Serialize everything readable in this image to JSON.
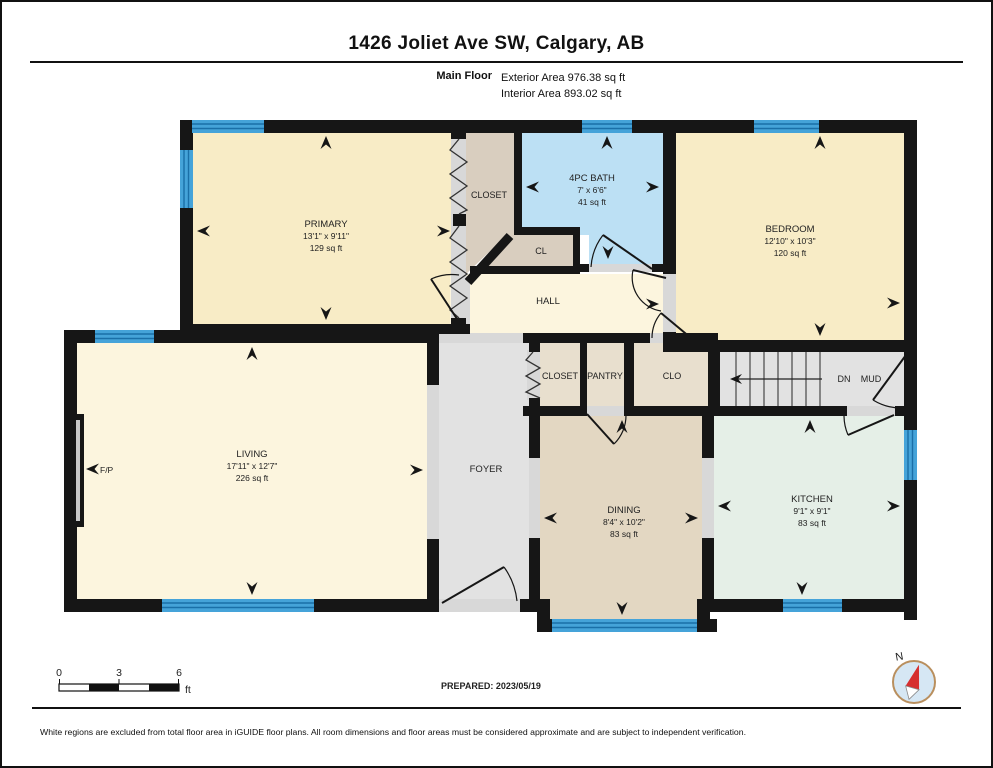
{
  "header": {
    "title": "1426 Joliet Ave SW, Calgary, AB",
    "floor_label": "Main Floor",
    "exterior_area": "Exterior Area 976.38 sq ft",
    "interior_area": "Interior Area 893.02 sq ft"
  },
  "rooms": {
    "primary": {
      "name": "PRIMARY",
      "dims": "13'1\" x 9'11\"",
      "area": "129 sq ft"
    },
    "closet_primary": {
      "name": "CLOSET"
    },
    "bath": {
      "name": "4PC BATH",
      "dims": "7' x 6'6\"",
      "area": "41 sq ft"
    },
    "cl": {
      "name": "CL"
    },
    "bedroom": {
      "name": "BEDROOM",
      "dims": "12'10\" x 10'3\"",
      "area": "120 sq ft"
    },
    "hall": {
      "name": "HALL"
    },
    "closet_center": {
      "name": "CLOSET"
    },
    "pantry": {
      "name": "PANTRY"
    },
    "clo": {
      "name": "CLO"
    },
    "stairs_down": {
      "name": "DN"
    },
    "mud": {
      "name": "MUD"
    },
    "living": {
      "name": "LIVING",
      "dims": "17'11\" x 12'7\"",
      "area": "226 sq ft"
    },
    "foyer": {
      "name": "FOYER"
    },
    "dining": {
      "name": "DINING",
      "dims": "8'4\" x 10'2\"",
      "area": "83 sq ft"
    },
    "kitchen": {
      "name": "KITCHEN",
      "dims": "9'1\" x 9'1\"",
      "area": "83 sq ft"
    },
    "fireplace": {
      "name": "F/P"
    }
  },
  "footer": {
    "scale": {
      "t0": "0",
      "t3": "3",
      "t6": "6",
      "unit": "ft"
    },
    "prepared": "PREPARED: 2023/05/19",
    "compass_label": "N",
    "disclaimer": "White regions are excluded from total floor area in iGUIDE floor plans. All room dimensions and floor areas must be considered approximate and are subject to independent verification."
  },
  "colors": {
    "wall_black": "#161616",
    "room_cream": "#F8ECC6",
    "room_cream_light": "#FCF5DE",
    "room_tan": "#D9CEBF",
    "room_tan_light": "#E8DFCE",
    "room_tan_mid": "#E3D7C2",
    "room_blue": "#BCE0F4",
    "room_mint": "#E5EFE7",
    "room_gray": "#E2E2E2",
    "threshold_gray": "#D8D8D8",
    "window_blue": "#45A3D9",
    "window_line": "#1A6FA8",
    "compass_red": "#D62F2F",
    "compass_ring": "#B98F5E",
    "compass_face": "#D6E7F4"
  }
}
